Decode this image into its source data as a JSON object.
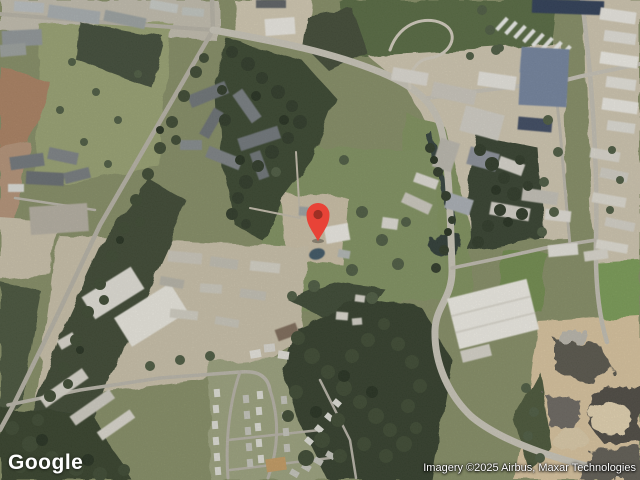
{
  "map": {
    "view_type": "satellite",
    "pin": {
      "label": "location-pin",
      "outer_color": "#e84337",
      "inner_color": "#9e2f24",
      "tip_x": 318,
      "tip_y": 240
    },
    "palette": {
      "field_green": "#8b9169",
      "forest_green": "#39442f",
      "industrial_tan": "#cdc4ae",
      "road_gray": "#c6c2b6",
      "quarry_sand": "#d6c19c",
      "water_dark": "#2e3b35"
    }
  },
  "branding": {
    "logo_text": "Google"
  },
  "attribution": {
    "text": "Imagery ©2025 Airbus, Maxar Technologies"
  }
}
